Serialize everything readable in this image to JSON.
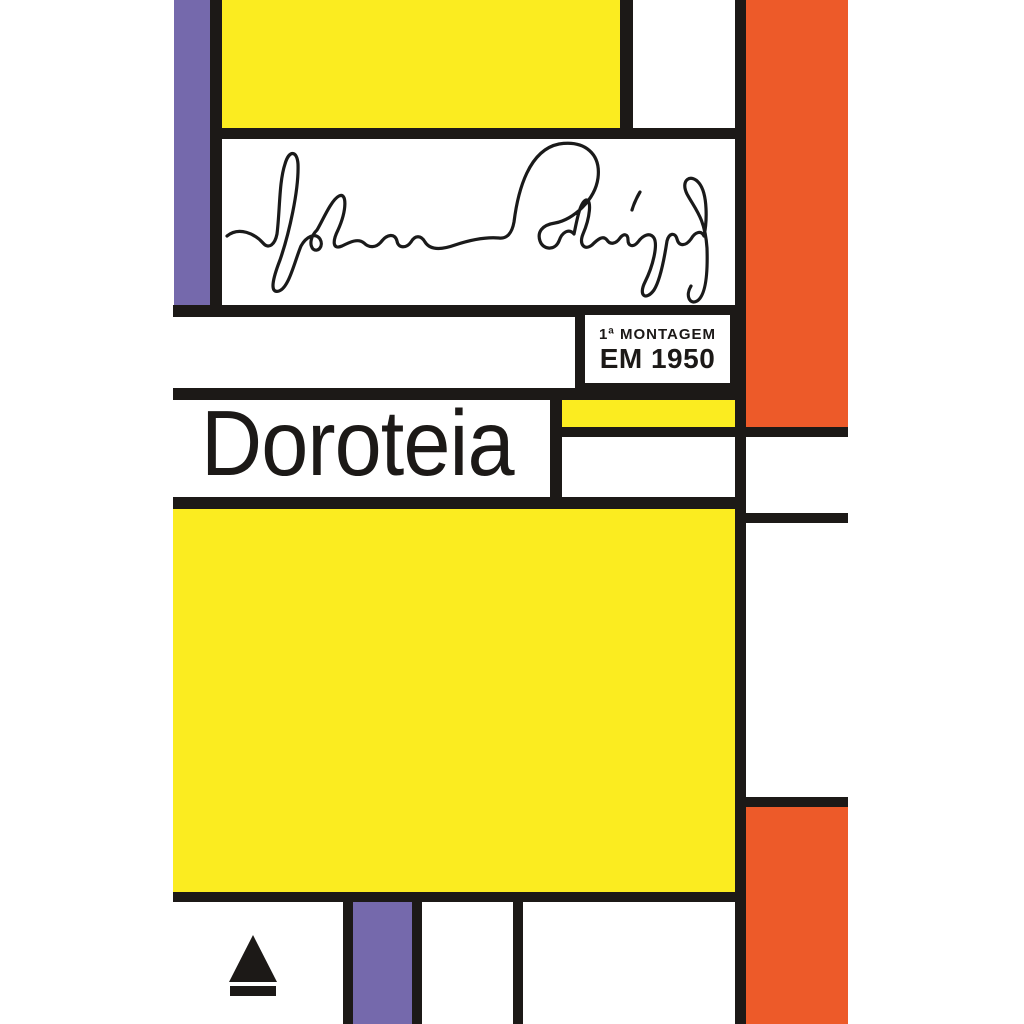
{
  "cover": {
    "title": "Doroteia",
    "badge": {
      "line1": "1ª MONTAGEM",
      "line2": "EM 1950"
    },
    "signature": {
      "name": "Nelson Rodrigues"
    },
    "publisher": {
      "logo": "Nova Fronteira triangle emblem"
    }
  },
  "colors": {
    "yellow": "#FBEC20",
    "purple": "#7569AC",
    "orange": "#ED5A29",
    "black": "#1C1917",
    "white": "#FFFFFF"
  }
}
